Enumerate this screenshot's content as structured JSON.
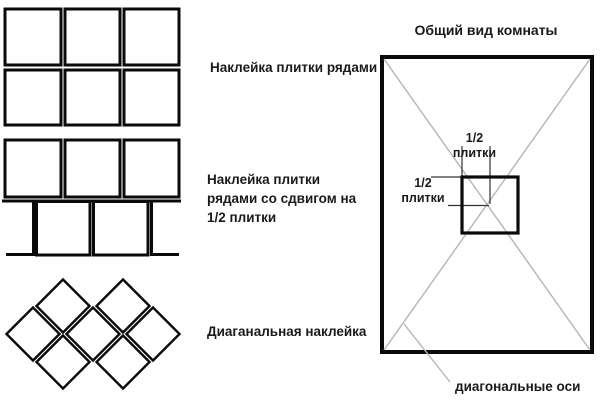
{
  "colors": {
    "ink": "#1a1a1a",
    "tile_line": "#0a0a0a",
    "axis_gray": "#b5b5b5",
    "background": "#ffffff"
  },
  "patterns": [
    {
      "id": "rows",
      "label": "Наклейка плитки рядами",
      "tiles": "2 rows x 3 square tiles"
    },
    {
      "id": "offset",
      "label_lines": [
        "Наклейка плитки",
        "рядами со сдвигом на",
        "1/2 плитки"
      ],
      "tiles": "2 rows, second row shifted by half tile"
    },
    {
      "id": "diagonal",
      "label": "Диаганальная наклейка",
      "tiles": "7 diamond tiles in 2-3-2 arrangement"
    }
  ],
  "room": {
    "title": "Общий вид комнаты",
    "half_tile_top": {
      "line1": "1/2",
      "line2": "плитки"
    },
    "half_tile_left": {
      "line1": "1/2",
      "line2": "плитки"
    },
    "diagonal_axes_label": "диагональные оси"
  }
}
